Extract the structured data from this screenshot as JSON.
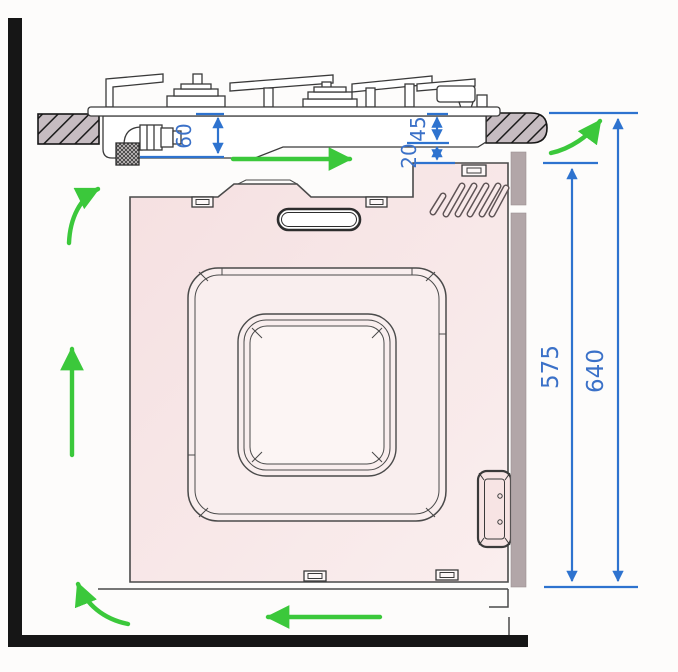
{
  "window": {
    "width": 678,
    "height": 672
  },
  "diagram": {
    "kind": "built-in oven installation clearance and ventilation diagram",
    "dimension_labels": {
      "hob_recess_depth": "60",
      "worktop_thickness": "45",
      "clearance_gap": "20",
      "niche_front_height": "575",
      "overall_height": "640"
    },
    "colors": {
      "dimension_blue": "#2e73cf",
      "dimension_text_blue": "#3b71c8",
      "airflow_green": "#3bc83b",
      "oven_body_pink": "#f7e4e4",
      "frame_inner_pink": "#fbf2f1",
      "rear_panel_gray": "#b2a6a8",
      "worktop_hatch_fill": "#c6bcc1",
      "structure_black": "#161616",
      "drawing_line": "#3a3a3a",
      "background": "#fdfcfb"
    }
  }
}
